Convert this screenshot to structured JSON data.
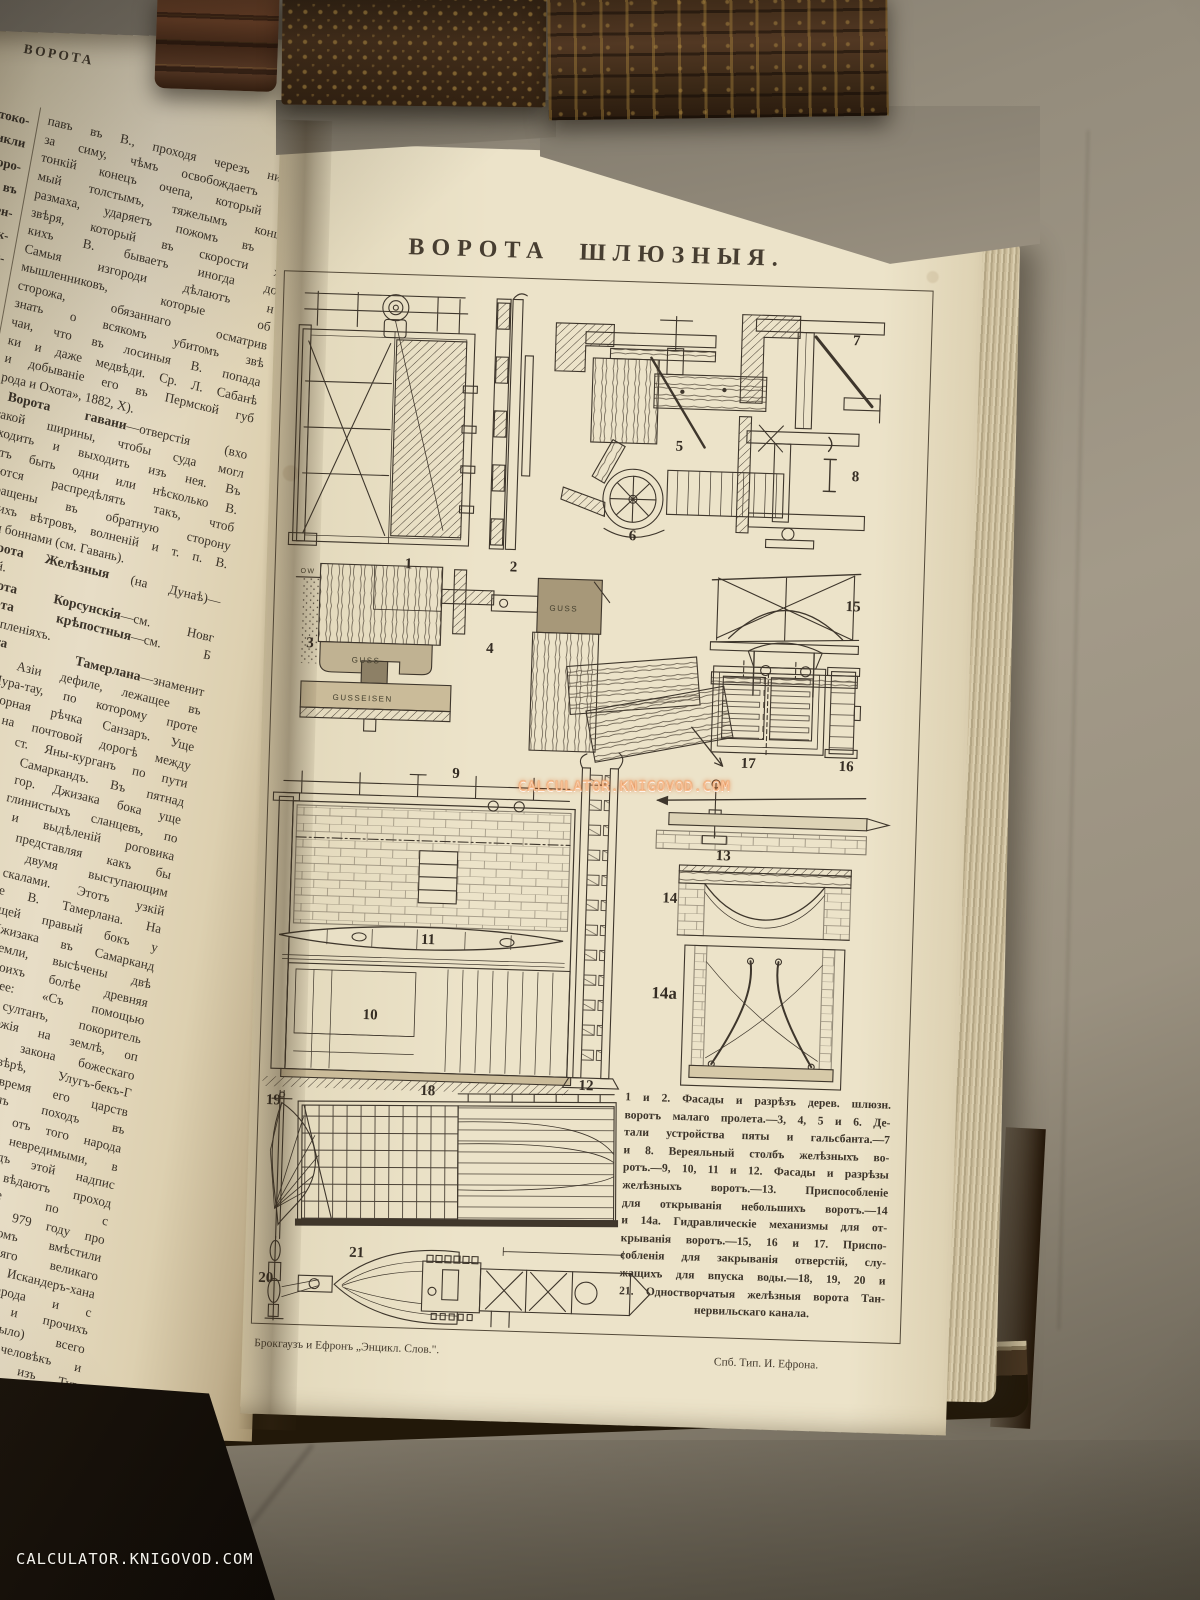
{
  "watermark": {
    "text": "CALCULATOR.KNIGOVOD.COM",
    "color": "#e87a3a"
  },
  "left_page": {
    "running_title": "ВОРОТА",
    "sliver_fragments": [
      "токо-",
      "никли",
      "горо-",
      "ь въ",
      "лен-",
      "унк-",
      "раи-",
      "зрѣ-",
      "то",
      "На-",
      "бе-",
      "ва",
      "и",
      "со-",
      "ть",
      "то-",
      "ли",
      "нь",
      "ѣ",
      "мъ"
    ],
    "lines": [
      {
        "b": "",
        "t": "павъ въ В., проходя черезъ нихъ,"
      },
      {
        "b": "",
        "t": "за симу, чѣмъ освобождаетъ оч"
      },
      {
        "b": "",
        "t": "тонкій конецъ очепа, который б"
      },
      {
        "b": "",
        "t": "мый толстымъ, тяжелымъ концо"
      },
      {
        "b": "",
        "t": "размаха, ударяетъ пожомъ въ с"
      },
      {
        "b": "",
        "t": "звѣря, который въ скорости х"
      },
      {
        "b": "",
        "t": "кихъ В. бываетъ иногда до"
      },
      {
        "b": "",
        "t": "Самыя изгороди дѣлаютъ н"
      },
      {
        "b": "",
        "t": "мышленниковъ, которые об"
      },
      {
        "b": "",
        "t": "сторожа, обязаннаго осматрив"
      },
      {
        "b": "",
        "t": "знать о всякомъ убитомъ звѣ"
      },
      {
        "b": "",
        "t": "чаи, что въ лосиныя В. попада"
      },
      {
        "b": "",
        "t": "ки и даже медвѣди. Ср. Л. Сабанѣ"
      },
      {
        "b": "",
        "t": "и добываніе его въ Пермской губ"
      },
      {
        "b": "",
        "t": "рода и Охота», 1882, X).",
        "e": 1
      },
      {
        "b": "Ворота гавани",
        "t": "—отверстія (вхо"
      },
      {
        "b": "",
        "t": "такой ширины, чтобы суда могл"
      },
      {
        "b": "",
        "t": "входить и выходить изъ нея. Въ"
      },
      {
        "b": "",
        "t": "гутъ быть одни или нѣсколько В."
      },
      {
        "b": "",
        "t": "раются распредѣлять такъ, чтоб"
      },
      {
        "b": "",
        "t": "обращены въ обратную сторону"
      },
      {
        "b": "",
        "t": "ющихъ вѣтровъ, волненій и т. п. В."
      },
      {
        "b": "",
        "t": "ются боннами (см. Гавань).",
        "e": 1
      },
      {
        "b": "Ворота Желѣзныя",
        "t": " (на Дунаѣ)—"
      },
      {
        "b": "",
        "t": "Дунай.",
        "e": 1
      },
      {
        "b": "Ворота Корсунскія",
        "t": "—см. Новг"
      },
      {
        "b": "Ворота крѣпостныя",
        "t": "—см. Б"
      },
      {
        "b": "",
        "t": "въ укрѣпленіяхъ.",
        "e": 1
      },
      {
        "b": "Ворота Тамерлана",
        "t": "—знаменит"
      },
      {
        "b": "",
        "t": "Средней Азіи дефиле, лежащее въ"
      },
      {
        "b": "",
        "t": "горъ Нура-тау, по которому проте"
      },
      {
        "b": "",
        "t": "страя горная рѣчка Санзаръ. Уще"
      },
      {
        "b": "",
        "t": "ходится на почтовой дорогѣ между"
      },
      {
        "b": "",
        "t": "закомъ и ст. Яны-курганъ по пути"
      },
      {
        "b": "",
        "t": "кента въ Самаркандъ. Въ пятнад"
      },
      {
        "b": "",
        "t": "стахъ отъ гор. Джизака бока уще"
      },
      {
        "b": "",
        "t": "щіе изъ глинистыхъ сланцевъ, по"
      },
      {
        "b": "",
        "t": "кварцитовъ и выдѣленій роговика"
      },
      {
        "b": "",
        "t": "буживаются, представляя какъ бы"
      },
      {
        "b": "",
        "t": "образованныя двумя выступающим"
      },
      {
        "b": "",
        "t": "ланцевыми скалами. Этотъ узкій"
      },
      {
        "b": "",
        "t": "ситъ названіе В. Тамерлана. На"
      },
      {
        "b": "",
        "t": "алѣ, образующей правый бокъ у"
      },
      {
        "b": "",
        "t": "рогѣ изъ Джизака въ Самарканд"
      },
      {
        "b": "",
        "t": "пяти отъ земли, высѣчены двѣ"
      },
      {
        "b": "",
        "t": "писи, изъ коихъ болѣе древняя"
      },
      {
        "b": "",
        "t": "ситъ слѣдующее: «Съ помощью"
      },
      {
        "b": "",
        "t": "а, великій султанъ, покоритель"
      },
      {
        "b": "",
        "t": "одовъ, тѣнь Божія на землѣ, оп"
      },
      {
        "b": "",
        "t": "еній Сунны и закона божескаго"
      },
      {
        "b": "",
        "t": "моществующій вѣрѣ, Улугъ-бекъ-Г"
      },
      {
        "b": "",
        "t": "продлитъ Богъ время его царств"
      },
      {
        "b": "",
        "t": "енія), предпринялъ походъ въ"
      },
      {
        "b": "",
        "t": "ы и монголовъ и отъ того народа"
      },
      {
        "b": "",
        "t": "въ эти страны невредимыми, в"
      },
      {
        "b": "",
        "t": "унномъ году». Подъ этой надпис"
      },
      {
        "b": "",
        "t": "ся другая: «Да вѣдаютъ проход"
      },
      {
        "b": "",
        "t": "и путешествующіе по с"
      },
      {
        "b": "",
        "t": "шѣ и водѣ, что въ 979 году про"
      },
      {
        "b": "",
        "t": "ніе между отрядомъ вмѣстили"
      },
      {
        "b": "",
        "t": "а, тѣни Всевышняго великаго"
      },
      {
        "b": "",
        "t": "а-хана, сына Искандеръ-хана"
      },
      {
        "b": "",
        "t": "человѣкъ боевого народа и с"
      },
      {
        "b": "",
        "t": "ъ-хана и Баба-хана и прочихъ"
      },
      {
        "b": "",
        "t": "казаннаго отряда (было) всего"
      },
      {
        "b": "",
        "t": "въ до 50 тысячъ человѣкъ и"
      },
      {
        "b": "",
        "t": "юдей до 400 тысячъ изъ Тур"
      },
      {
        "b": "",
        "t": "Ферганы и Дешта-Кипчака. С"
      },
      {
        "b": "",
        "t": "счастливаго сочетанія звѣздъ",
        "e": 1
      }
    ]
  },
  "plate": {
    "title": "ВОРОТА ШЛЮЗНЫЯ.",
    "figures": [
      "1",
      "2",
      "3",
      "4",
      "5",
      "6",
      "7",
      "8",
      "9",
      "10",
      "11",
      "12",
      "13",
      "14",
      "14a",
      "15",
      "16",
      "17",
      "18",
      "19",
      "20",
      "21"
    ],
    "annotations": {
      "guss": "GUSS",
      "gusseisen": "GUSSEISEN",
      "ow": "OW"
    },
    "caption_lines": [
      "1 и 2. Фасады и разрѣзъ дерев. шлюзн.",
      "воротъ малаго пролета.—3, 4, 5 и 6. Де-",
      "тали устройства пяты и гальсбанта.—7",
      "и 8. Вереяльный столбъ желѣзныхъ во-",
      "ротъ.—9, 10, 11 и 12. Фасады и разрѣзы",
      "желѣзныхъ воротъ.—13. Приспособленіе",
      "для открыванія небольшихъ воротъ.—14",
      "и 14а. Гидравлическіе механизмы для от-",
      "крыванія воротъ.—15, 16 и 17. Приспо-",
      "собленія для закрыванія отверстій, слу-",
      "жащихъ для впуска воды.—18, 19, 20 и",
      "21. Одностворчатыя желѣзныя ворота Тан-",
      "нервильскаго канала."
    ],
    "imprint_left": "Брокгаузъ и Ефронъ „Энцикл. Слов.\".",
    "imprint_right": "Спб. Тип. И. Ефрона."
  },
  "colors": {
    "paper": "#ece3c9",
    "ink": "#3e362c",
    "fabric": "#948c7c"
  }
}
